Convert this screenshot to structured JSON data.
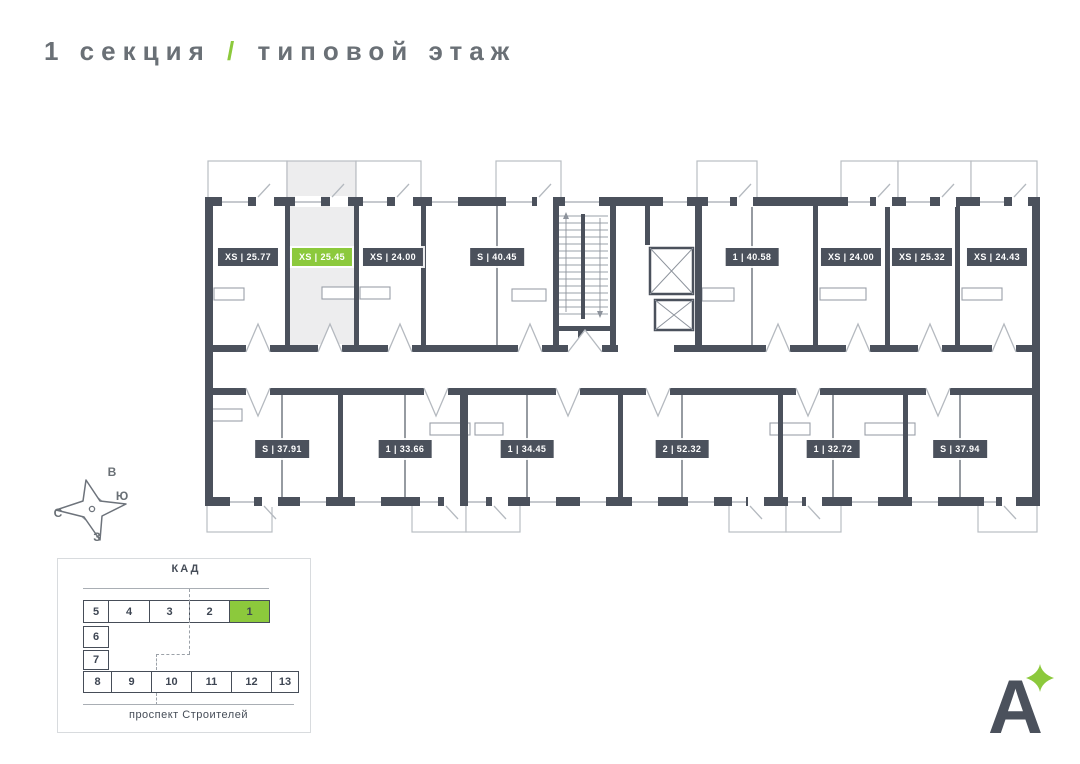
{
  "title": {
    "section": "1 секция",
    "divider": "/",
    "floor": "типовой этаж"
  },
  "colors": {
    "accent_green": "#8cc93c",
    "wall_dark": "#4b515c",
    "highlight_fill": "#ededee",
    "title_grey": "#6a7076"
  },
  "compass": {
    "top": "В",
    "right": "Ю",
    "left": "С",
    "bottom": "З"
  },
  "plan": {
    "apartments": [
      {
        "type": "XS",
        "area": "25.77",
        "label": "XS | 25.77",
        "row": "top",
        "highlighted": false
      },
      {
        "type": "XS",
        "area": "25.45",
        "label": "XS | 25.45",
        "row": "top",
        "highlighted": true
      },
      {
        "type": "XS",
        "area": "24.00",
        "label": "XS | 24.00",
        "row": "top",
        "highlighted": false
      },
      {
        "type": "S",
        "area": "40.45",
        "label": "S | 40.45",
        "row": "top",
        "highlighted": false
      },
      {
        "type": "1",
        "area": "40.58",
        "label": "1 | 40.58",
        "row": "top",
        "highlighted": false
      },
      {
        "type": "XS",
        "area": "24.00",
        "label": "XS | 24.00",
        "row": "top",
        "highlighted": false
      },
      {
        "type": "XS",
        "area": "25.32",
        "label": "XS | 25.32",
        "row": "top",
        "highlighted": false
      },
      {
        "type": "XS",
        "area": "24.43",
        "label": "XS | 24.43",
        "row": "top",
        "highlighted": false
      },
      {
        "type": "S",
        "area": "37.91",
        "label": "S | 37.91",
        "row": "bottom",
        "highlighted": false
      },
      {
        "type": "1",
        "area": "33.66",
        "label": "1 | 33.66",
        "row": "bottom",
        "highlighted": false
      },
      {
        "type": "1",
        "area": "34.45",
        "label": "1 | 34.45",
        "row": "bottom",
        "highlighted": false
      },
      {
        "type": "2",
        "area": "52.32",
        "label": "2 | 52.32",
        "row": "bottom",
        "highlighted": false
      },
      {
        "type": "1",
        "area": "32.72",
        "label": "1 | 32.72",
        "row": "bottom",
        "highlighted": false
      },
      {
        "type": "S",
        "area": "37.94",
        "label": "S | 37.94",
        "row": "bottom",
        "highlighted": false
      }
    ]
  },
  "minimap": {
    "top_road": "КАД",
    "bottom_road": "проспект Строителей",
    "highlighted_section": "1",
    "sections": [
      {
        "label": "5"
      },
      {
        "label": "4"
      },
      {
        "label": "3"
      },
      {
        "label": "2"
      },
      {
        "label": "1"
      },
      {
        "label": "6"
      },
      {
        "label": "7"
      },
      {
        "label": "8"
      },
      {
        "label": "9"
      },
      {
        "label": "10"
      },
      {
        "label": "11"
      },
      {
        "label": "12"
      },
      {
        "label": "13"
      }
    ]
  },
  "logo": {
    "letter": "А"
  }
}
